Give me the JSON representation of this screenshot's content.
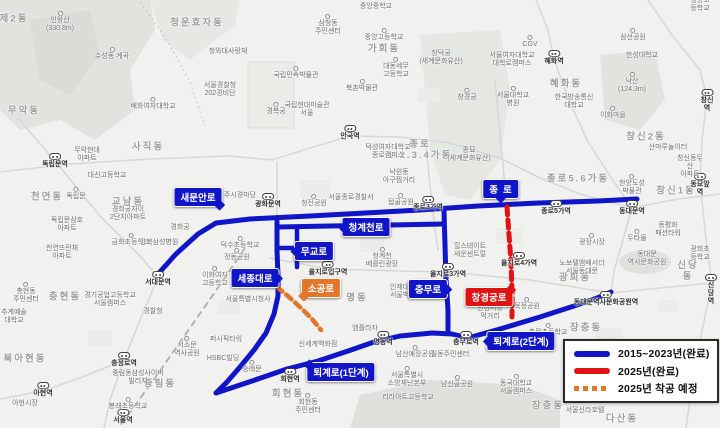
{
  "colors": {
    "route_completed_blue": "#1015c8",
    "route_completed_2025_red": "#e01212",
    "route_planned_2025_orange": "#e2762a",
    "map_background": "#f1f1ef"
  },
  "legend": {
    "items": [
      {
        "label": "2015~2023년(완료)",
        "swatch": "solid-blue"
      },
      {
        "label": "2025년(완료)",
        "swatch": "solid-red"
      },
      {
        "label": "2025년 착공 예정",
        "swatch": "dashed-orange"
      }
    ]
  },
  "road_labels": {
    "saemunanro": "새문안로",
    "jongno": "종로",
    "cheonggyecheonro": "청계천로",
    "mugyoro": "무교로",
    "sejongdaero": "세종대로",
    "sogongro": "소공로",
    "chungmuro": "충무로",
    "changgyeonggungro": "창경궁로",
    "toegyero1": "퇴계로(1단계)",
    "toegyero2": "퇴계로(2단계)"
  },
  "map_labels": [
    {
      "t": "제2동",
      "x": 14,
      "y": 20,
      "k": "d"
    },
    {
      "t": "청운효자동",
      "x": 197,
      "y": 24,
      "k": "d"
    },
    {
      "t": "사직동",
      "x": 148,
      "y": 148,
      "k": "d"
    },
    {
      "t": "무악동",
      "x": 24,
      "y": 112,
      "k": "d"
    },
    {
      "t": "천연동",
      "x": 47,
      "y": 198,
      "k": "d"
    },
    {
      "t": "교남동",
      "x": 128,
      "y": 203,
      "k": "d"
    },
    {
      "t": "가회동",
      "x": 384,
      "y": 50,
      "k": "d"
    },
    {
      "t": "혜화동",
      "x": 566,
      "y": 85,
      "k": "d"
    },
    {
      "t": "종로\n1.2.3.4가동",
      "x": 420,
      "y": 151,
      "k": "d"
    },
    {
      "t": "종로5.6가동",
      "x": 578,
      "y": 180,
      "k": "d"
    },
    {
      "t": "창신2동",
      "x": 646,
      "y": 138,
      "k": "d"
    },
    {
      "t": "창신1동",
      "x": 676,
      "y": 192,
      "k": "d"
    },
    {
      "t": "명동",
      "x": 357,
      "y": 299,
      "k": "d"
    },
    {
      "t": "회현동",
      "x": 288,
      "y": 395,
      "k": "d"
    },
    {
      "t": "충현동",
      "x": 65,
      "y": 298,
      "k": "d"
    },
    {
      "t": "북아현동",
      "x": 25,
      "y": 360,
      "k": "d"
    },
    {
      "t": "중림동",
      "x": 160,
      "y": 385,
      "k": "d"
    },
    {
      "t": "신당동",
      "x": 688,
      "y": 272,
      "k": "d"
    },
    {
      "t": "광희동",
      "x": 575,
      "y": 279,
      "k": "d"
    },
    {
      "t": "장충동",
      "x": 586,
      "y": 329,
      "k": "d"
    },
    {
      "t": "장충동",
      "x": 548,
      "y": 407,
      "k": "d"
    },
    {
      "t": "다산동",
      "x": 622,
      "y": 420,
      "k": "d"
    },
    {
      "t": "독립문역",
      "x": 55,
      "y": 159,
      "k": "st"
    },
    {
      "t": "서대문역",
      "x": 158,
      "y": 277,
      "k": "st"
    },
    {
      "t": "충정로역",
      "x": 124,
      "y": 358,
      "k": "st"
    },
    {
      "t": "아현역",
      "x": 43,
      "y": 388,
      "k": "st"
    },
    {
      "t": "서울역",
      "x": 123,
      "y": 415,
      "k": "st"
    },
    {
      "t": "광화문역",
      "x": 268,
      "y": 199,
      "k": "st"
    },
    {
      "t": "안국역",
      "x": 350,
      "y": 131,
      "k": "st"
    },
    {
      "t": "종로3가역",
      "x": 428,
      "y": 202,
      "k": "st"
    },
    {
      "t": "종로5가역",
      "x": 556,
      "y": 206,
      "k": "st"
    },
    {
      "t": "동대문역",
      "x": 632,
      "y": 206,
      "k": "st"
    },
    {
      "t": "동묘앞역",
      "x": 700,
      "y": 179,
      "k": "st"
    },
    {
      "t": "창신역",
      "x": 707,
      "y": 95,
      "k": "st"
    },
    {
      "t": "혜화역",
      "x": 554,
      "y": 56,
      "k": "st"
    },
    {
      "t": "을지로입구역",
      "x": 328,
      "y": 267,
      "k": "st"
    },
    {
      "t": "을지로3가역",
      "x": 448,
      "y": 269,
      "k": "st"
    },
    {
      "t": "을지로4가역",
      "x": 519,
      "y": 258,
      "k": "st"
    },
    {
      "t": "충무로역",
      "x": 466,
      "y": 337,
      "k": "st"
    },
    {
      "t": "명동역",
      "x": 383,
      "y": 337,
      "k": "st"
    },
    {
      "t": "회현역",
      "x": 290,
      "y": 374,
      "k": "st"
    },
    {
      "t": "동대문역사문화공원역",
      "x": 606,
      "y": 297,
      "k": "st"
    },
    {
      "t": "신당역",
      "x": 711,
      "y": 280,
      "k": "st"
    },
    {
      "t": "인왕산\n(330.8m)",
      "x": 60,
      "y": 22,
      "k": "p"
    },
    {
      "t": "수성동 계곡",
      "x": 112,
      "y": 54,
      "k": "p"
    },
    {
      "t": "청와대사랑채",
      "x": 228,
      "y": 52,
      "k": "n"
    },
    {
      "t": "서울경찰청\n202경비단",
      "x": 220,
      "y": 90,
      "k": "n"
    },
    {
      "t": "배화여자대학교",
      "x": 153,
      "y": 104,
      "k": "p"
    },
    {
      "t": "삼청동\n주민센터",
      "x": 328,
      "y": 25,
      "k": "p"
    },
    {
      "t": "중앙중학교",
      "x": 376,
      "y": 7,
      "k": "n"
    },
    {
      "t": "중앙고등학교",
      "x": 384,
      "y": 35,
      "k": "p"
    },
    {
      "t": "창덕궁\n(세계문화유산)",
      "x": 441,
      "y": 58,
      "k": "n"
    },
    {
      "t": "대동세무\n고등학교",
      "x": 396,
      "y": 68,
      "k": "p"
    },
    {
      "t": "북촌박물관",
      "x": 362,
      "y": 86,
      "k": "p"
    },
    {
      "t": "국립민속박물관",
      "x": 296,
      "y": 73,
      "k": "p"
    },
    {
      "t": "경복궁",
      "x": 276,
      "y": 109,
      "k": "p"
    },
    {
      "t": "국립현대미술관\n서울",
      "x": 307,
      "y": 110,
      "k": "n"
    },
    {
      "t": "창경궁",
      "x": 467,
      "y": 95,
      "k": "p"
    },
    {
      "t": "종묘\n(세계문화유산)",
      "x": 469,
      "y": 155,
      "k": "n"
    },
    {
      "t": "CGV",
      "x": 530,
      "y": 42,
      "k": "p"
    },
    {
      "t": "서울여자대학교\n대학로캠퍼스",
      "x": 512,
      "y": 60,
      "k": "n"
    },
    {
      "t": "서울대학교\n병원",
      "x": 513,
      "y": 97,
      "k": "p"
    },
    {
      "t": "한국방송통신\n대학교",
      "x": 574,
      "y": 102,
      "k": "n"
    },
    {
      "t": "이화마을",
      "x": 613,
      "y": 113,
      "k": "p"
    },
    {
      "t": "삼선공원",
      "x": 633,
      "y": 35,
      "k": "p"
    },
    {
      "t": "한성대학교",
      "x": 642,
      "y": 56,
      "k": "n"
    },
    {
      "t": "낙산\n(124.3m)",
      "x": 632,
      "y": 83,
      "k": "p"
    },
    {
      "t": "경동고등학교",
      "x": 700,
      "y": 5,
      "k": "n"
    },
    {
      "t": "산마루놀이터",
      "x": 668,
      "y": 148,
      "k": "n"
    },
    {
      "t": "창신동두산\n아파트",
      "x": 690,
      "y": 167,
      "k": "n"
    },
    {
      "t": "한양도성\n박물관",
      "x": 632,
      "y": 185,
      "k": "p"
    },
    {
      "t": "무악현대\n아파트",
      "x": 87,
      "y": 155,
      "k": "n"
    },
    {
      "t": "대신고등학교",
      "x": 107,
      "y": 176,
      "k": "n"
    },
    {
      "t": "독립문",
      "x": 76,
      "y": 194,
      "k": "p"
    },
    {
      "t": "경희궁자이\n2단지아파트",
      "x": 128,
      "y": 214,
      "k": "n"
    },
    {
      "t": "독립문삼호\n아파트",
      "x": 67,
      "y": 225,
      "k": "n"
    },
    {
      "t": "금화초등학교",
      "x": 131,
      "y": 240,
      "k": "p"
    },
    {
      "t": "천연뜨란채\n아파트",
      "x": 62,
      "y": 253,
      "k": "n"
    },
    {
      "t": "강북삼성병원",
      "x": 159,
      "y": 243,
      "k": "n"
    },
    {
      "t": "경희궁",
      "x": 180,
      "y": 228,
      "k": "n"
    },
    {
      "t": "주시경마당",
      "x": 240,
      "y": 196,
      "k": "n"
    },
    {
      "t": "청진공원",
      "x": 314,
      "y": 201,
      "k": "p"
    },
    {
      "t": "덕수초등학교",
      "x": 240,
      "y": 243,
      "k": "p"
    },
    {
      "t": "정동공원",
      "x": 237,
      "y": 255,
      "k": "p"
    },
    {
      "t": "이화여자\n고등학교",
      "x": 215,
      "y": 277,
      "k": "p"
    },
    {
      "t": "경찰청",
      "x": 153,
      "y": 312,
      "k": "n"
    },
    {
      "t": "경기공업고등학교\n서울캠퍼스",
      "x": 110,
      "y": 300,
      "k": "n"
    },
    {
      "t": "추계예술\n대학교",
      "x": 14,
      "y": 317,
      "k": "n"
    },
    {
      "t": "충현동\n주민센터",
      "x": 26,
      "y": 293,
      "k": "p"
    },
    {
      "t": "아현시장",
      "x": 25,
      "y": 404,
      "k": "n"
    },
    {
      "t": "중림동삼성사이버\n빌리지",
      "x": 138,
      "y": 378,
      "k": "n"
    },
    {
      "t": "봉래초등학교",
      "x": 128,
      "y": 404,
      "k": "p"
    },
    {
      "t": "서소문\n역사공원",
      "x": 187,
      "y": 347,
      "k": "p"
    },
    {
      "t": "퍼시픽타워",
      "x": 226,
      "y": 340,
      "k": "n"
    },
    {
      "t": "HSBC빌딩",
      "x": 223,
      "y": 359,
      "k": "n"
    },
    {
      "t": "숭례문",
      "x": 252,
      "y": 367,
      "k": "p"
    },
    {
      "t": "회현동\n주민센터",
      "x": 308,
      "y": 404,
      "k": "p"
    },
    {
      "t": "서울특별시청사",
      "x": 248,
      "y": 300,
      "k": "n"
    },
    {
      "t": "신세계백화점",
      "x": 318,
      "y": 345,
      "k": "n"
    },
    {
      "t": "남산예장공원",
      "x": 415,
      "y": 352,
      "k": "p"
    },
    {
      "t": "서울특별시\n소방재난본부",
      "x": 407,
      "y": 377,
      "k": "p"
    },
    {
      "t": "리라아트고등학교",
      "x": 408,
      "y": 398,
      "k": "n"
    },
    {
      "t": "남산골공원",
      "x": 457,
      "y": 382,
      "k": "p"
    },
    {
      "t": "필동주민센터",
      "x": 450,
      "y": 355,
      "k": "n"
    },
    {
      "t": "동국대학교\n서울캠퍼스",
      "x": 516,
      "y": 385,
      "k": "p"
    },
    {
      "t": "서울신라호텔",
      "x": 585,
      "y": 411,
      "k": "n"
    },
    {
      "t": "묵정공원",
      "x": 527,
      "y": 304,
      "k": "p"
    },
    {
      "t": "인현시장\n먹거리",
      "x": 490,
      "y": 313,
      "k": "n"
    },
    {
      "t": "충무초등학교",
      "x": 548,
      "y": 330,
      "k": "p"
    },
    {
      "t": "인제대학교\n서울백병원",
      "x": 406,
      "y": 292,
      "k": "n"
    },
    {
      "t": "엠플라자",
      "x": 365,
      "y": 329,
      "k": "n"
    },
    {
      "t": "청계천\n베를린광장",
      "x": 382,
      "y": 258,
      "k": "p"
    },
    {
      "t": "힐스테이트\n세운센트럴",
      "x": 470,
      "y": 251,
      "k": "n"
    },
    {
      "t": "서울종로경찰서",
      "x": 351,
      "y": 198,
      "k": "n"
    },
    {
      "t": "탑골공원",
      "x": 401,
      "y": 200,
      "k": "p"
    },
    {
      "t": "낙원동\n아구찜거리",
      "x": 399,
      "y": 177,
      "k": "n"
    },
    {
      "t": "덕성여자대학교\n종로캠퍼스",
      "x": 388,
      "y": 152,
      "k": "n"
    },
    {
      "t": "광장시장",
      "x": 592,
      "y": 240,
      "k": "p"
    },
    {
      "t": "두타몰",
      "x": 637,
      "y": 236,
      "k": "p"
    },
    {
      "t": "동평화\n패션타워",
      "x": 668,
      "y": 230,
      "k": "n"
    },
    {
      "t": "동대문\n역사문화공원",
      "x": 647,
      "y": 259,
      "k": "n"
    },
    {
      "t": "노보텔앰배서더\n서울동대문",
      "x": 582,
      "y": 268,
      "k": "n"
    },
    {
      "t": "광희초등학교",
      "x": 700,
      "y": 254,
      "k": "n"
    }
  ]
}
